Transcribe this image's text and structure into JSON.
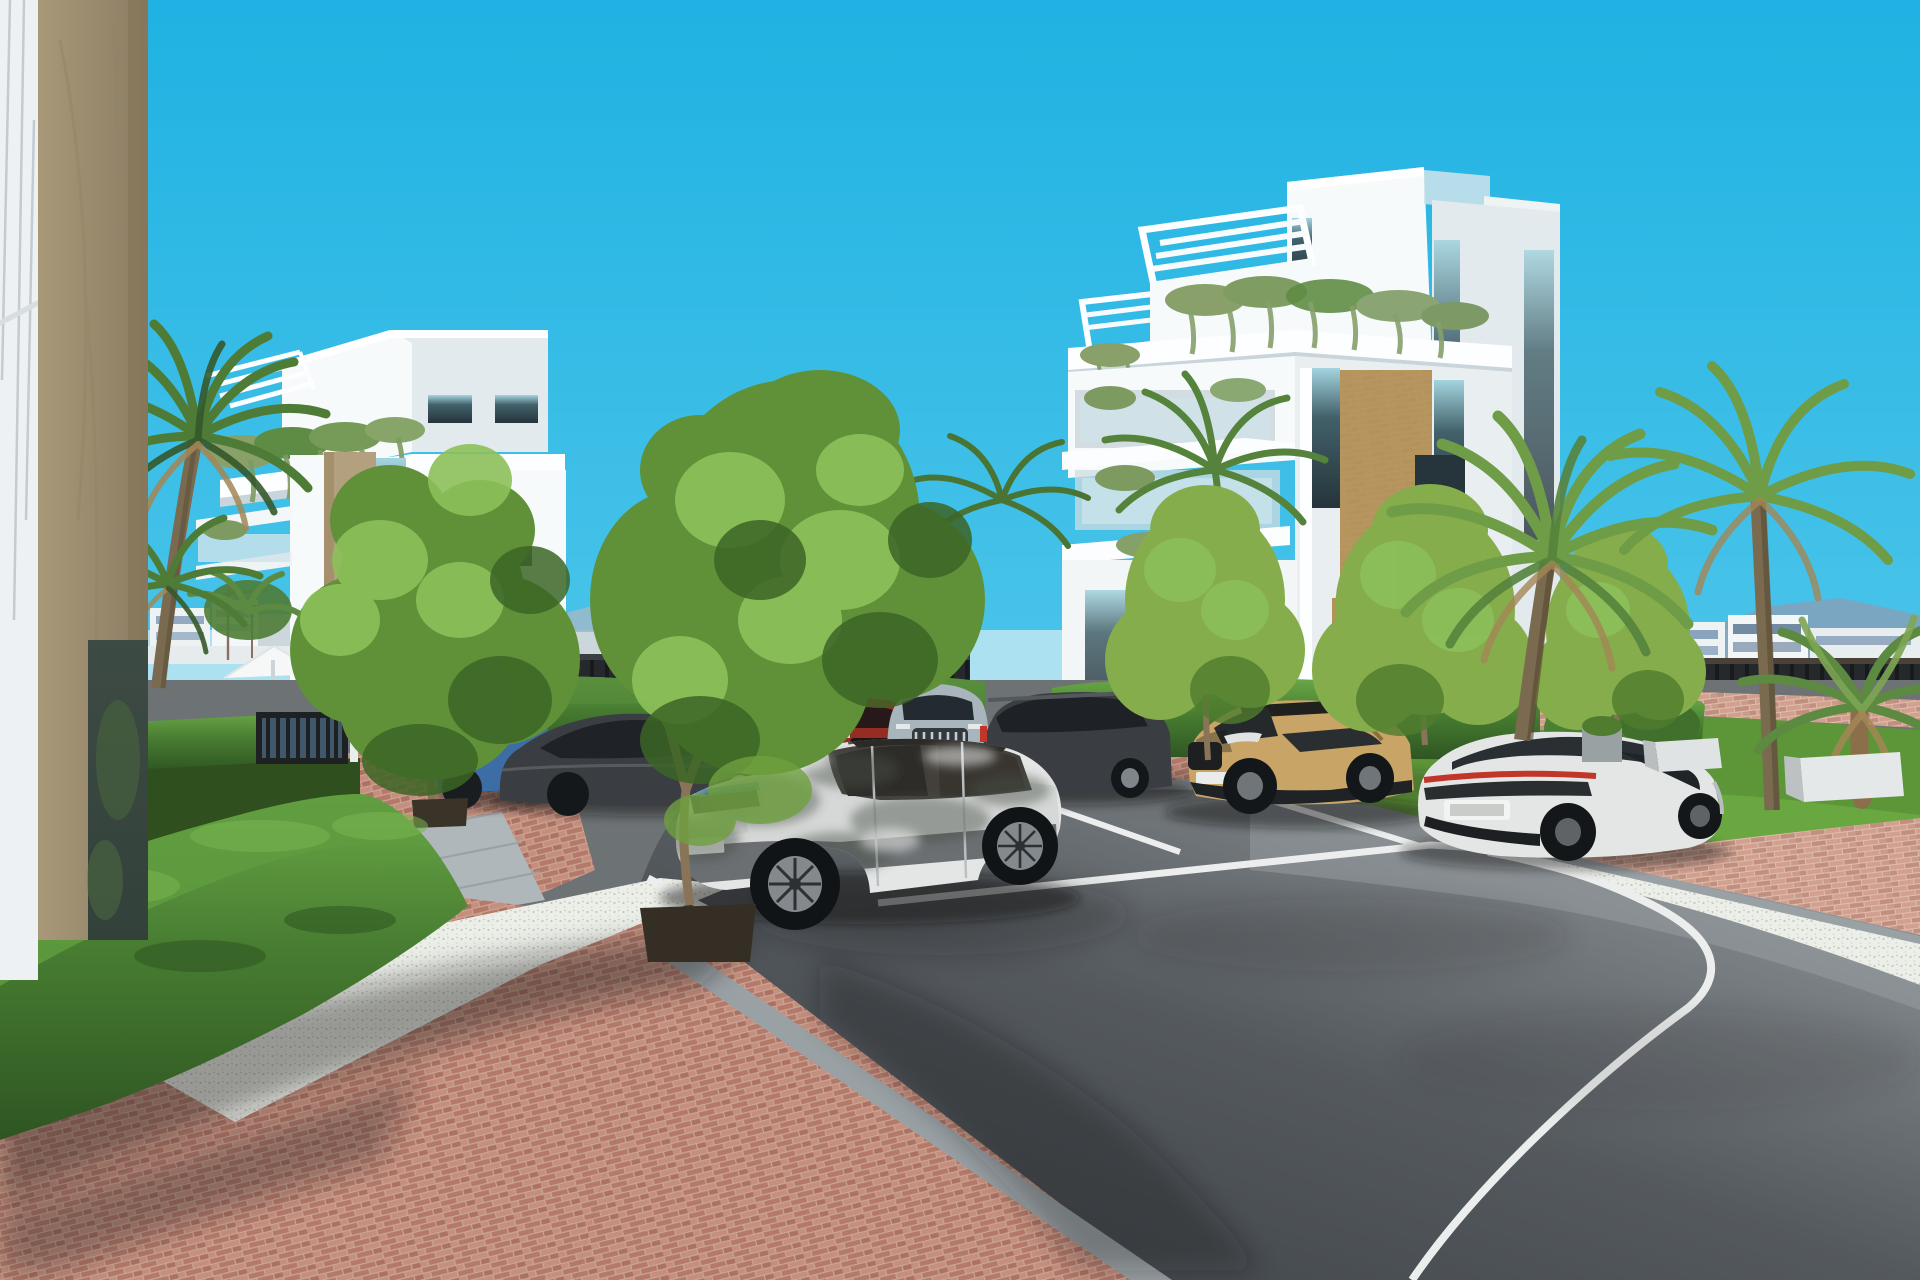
{
  "scene": {
    "type": "architectural-rendering",
    "setting": "Sunny 3D render of a modern white Mediterranean apartment complex with parking lot, palm trees, clipped hedges, brick pavement and a curving asphalt road",
    "objects": [
      "foreground-building-corner",
      "left-apartment-building",
      "right-apartment-building",
      "left-palm-trees",
      "right-palm-trees",
      "deciduous-trees",
      "boxwood-hedges",
      "white-parasol",
      "sun-loungers",
      "perimeter-fence",
      "distant-city-skyline",
      "mountains",
      "construction-cranes",
      "white-gravel-bed",
      "brick-pavement",
      "asphalt-road",
      "parking-stall-lines",
      "white-suv-foreground",
      "dark-gray-sedan",
      "blue-hatchback",
      "red-suv",
      "silver-suv",
      "dark-gray-suv",
      "tan-crossover-suv",
      "white-coupe-sedan",
      "distant-driving-car",
      "lawn",
      "concrete-benches"
    ]
  },
  "palette": {
    "sky_top": "#1fb2e2",
    "sky_mid": "#4cc5ea",
    "sky_horizon": "#b5e7f4",
    "haze": "#e2f1f6",
    "mountain": "#9db8c9",
    "mountain_right": "#7fa3bd",
    "city_white": "#eef2f2",
    "city_shade": "#ccd7db",
    "city_blue": "#48709a",
    "city_dark": "#2e4a68",
    "city_tan": "#c9a67c",
    "fence_dark": "#26292c",
    "fence_post": "#171b1e",
    "bldg_white": "#f7fafa",
    "bldg_shade": "#e3eaed",
    "bldg_fascia": "#fdfeff",
    "bldg_recess": "#c9d5da",
    "stone_tan": "#b3a07e",
    "stone_tan_dark": "#97835f",
    "cladding_ochre": "#b29257",
    "window_teal": "#42616a",
    "window_dark": "#26343b",
    "window_sky": "#a3d4df",
    "glass_rail": "#cfe4ea",
    "plant_sage": "#8aa06b",
    "plant_green": "#5f8c44",
    "tree_light": "#8cc05a",
    "tree_mid": "#609138",
    "tree_dark": "#3c6526",
    "tree_yellow": "#85ad4b",
    "palm_green": "#4e7c36",
    "palm_dark": "#35592a",
    "palm_brown": "#a38756",
    "trunk_brown": "#8a7458",
    "hedge_light": "#69a746",
    "hedge_mid": "#477c31",
    "hedge_dark": "#2e5522",
    "lawn_green": "#5d9638",
    "lawn_dark": "#2f4f1e",
    "brick_base": "#b5796a",
    "brick_light": "#c58e7d",
    "brick_mortar": "#c9a695",
    "brick_sun": "#d2a08f",
    "brick_sun2": "#c08f7f",
    "gravel_white": "#eceee8",
    "gravel_dot": "#c4c8c2",
    "curb_gray": "#9aa1a5",
    "paver_gray": "#b0b7ba",
    "asphalt_dark": "#393e43",
    "asphalt_mid": "#54595e",
    "asphalt_light": "#9aa0a3",
    "line_white": "#eceeee",
    "car_white": "#e4e6e5",
    "car_white_shade": "#b7bdc0",
    "car_dark": "#3a3e43",
    "car_darker": "#26292d",
    "car_blue": "#3c6da5",
    "car_red": "#962d22",
    "car_silver": "#a8b5bd",
    "car_tan": "#c8a566",
    "car_tan_dark": "#8a6f3e",
    "taillight_red": "#c23529",
    "shadow_soft": "rgba(22,26,20,0.40)",
    "shadow_light": "rgba(22,26,20,0.22)",
    "corner_white": "#edf1f3",
    "corner_tan": "#a89878",
    "corner_tan_dark": "#8b7d63",
    "corner_glass": "#33413b"
  }
}
